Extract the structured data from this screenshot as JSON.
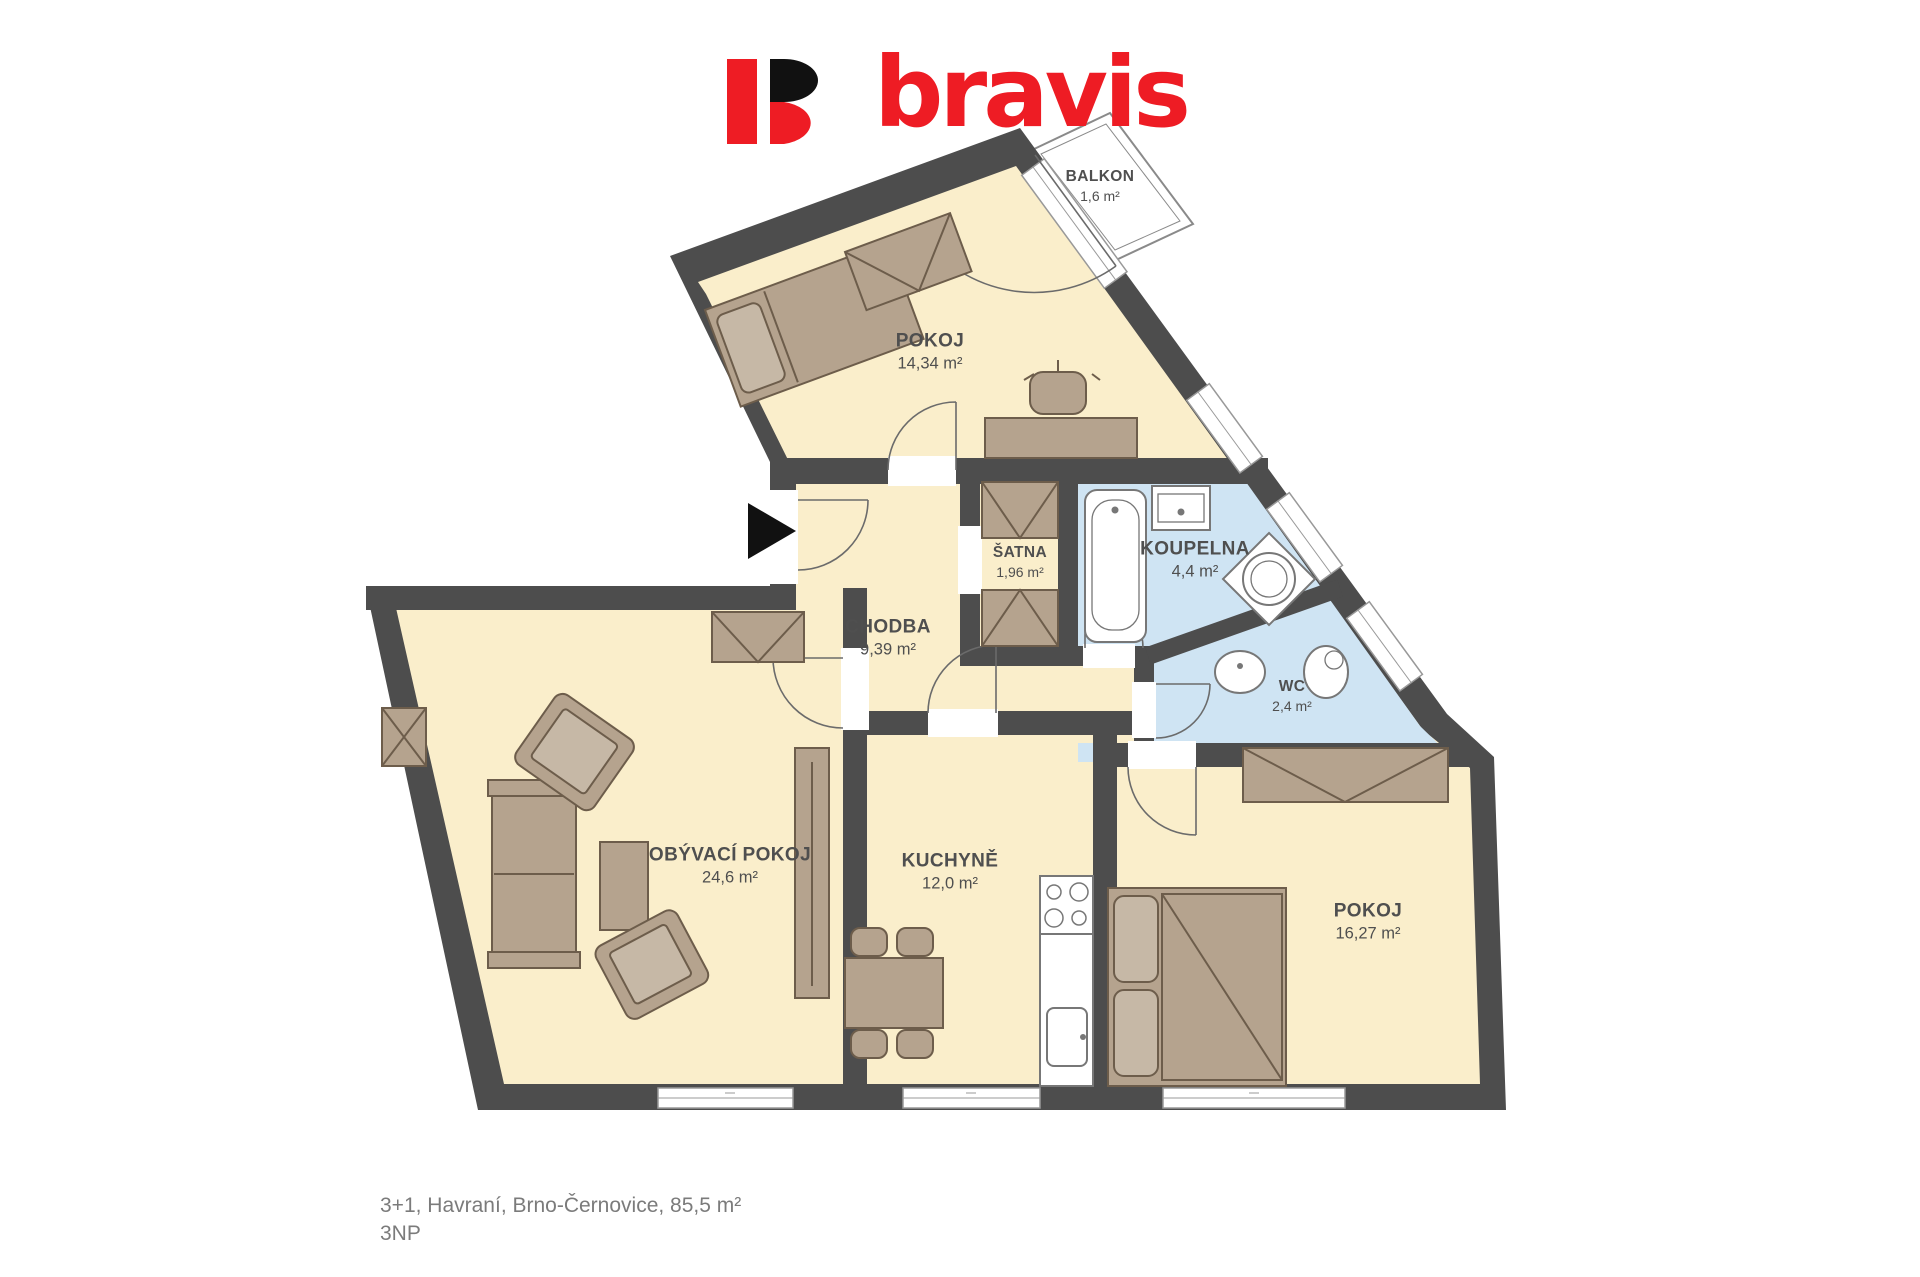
{
  "logo": {
    "text": "bravis"
  },
  "rooms": [
    {
      "id": "pokoj-1",
      "name": "POKOJ",
      "area": "14,34 m²"
    },
    {
      "id": "balkon",
      "name": "BALKON",
      "area": "1,6 m²"
    },
    {
      "id": "satna",
      "name": "ŠATNA",
      "area": "1,96 m²"
    },
    {
      "id": "koupelna",
      "name": "KOUPELNA",
      "area": "4,4 m²"
    },
    {
      "id": "chodba",
      "name": "CHODBA",
      "area": "9,39 m²"
    },
    {
      "id": "wc",
      "name": "WC",
      "area": "2,4 m²"
    },
    {
      "id": "obyvaci-pokoj",
      "name": "OBÝVACÍ POKOJ",
      "area": "24,6 m²"
    },
    {
      "id": "kuchyne",
      "name": "KUCHYNĚ",
      "area": "12,0 m²"
    },
    {
      "id": "pokoj-2",
      "name": "POKOJ",
      "area": "16,27 m²"
    }
  ],
  "caption": {
    "line1": "3+1, Havraní, Brno-Černovice, 85,5 m²",
    "line2": "3NP"
  },
  "colors": {
    "wall": "#4d4d4d",
    "floor": "#faeecb",
    "wet_room": "#cfe4f3",
    "furniture": "#b5a38e",
    "furniture_light": "#c6b8a6",
    "furniture_outline": "#6d5d4b",
    "fixture_outline": "#777777",
    "window_line": "#999999",
    "logo_red": "#ee1c24",
    "logo_black": "#111111",
    "label_text": "#4f4f4f",
    "caption_text": "#7b7b7b"
  }
}
